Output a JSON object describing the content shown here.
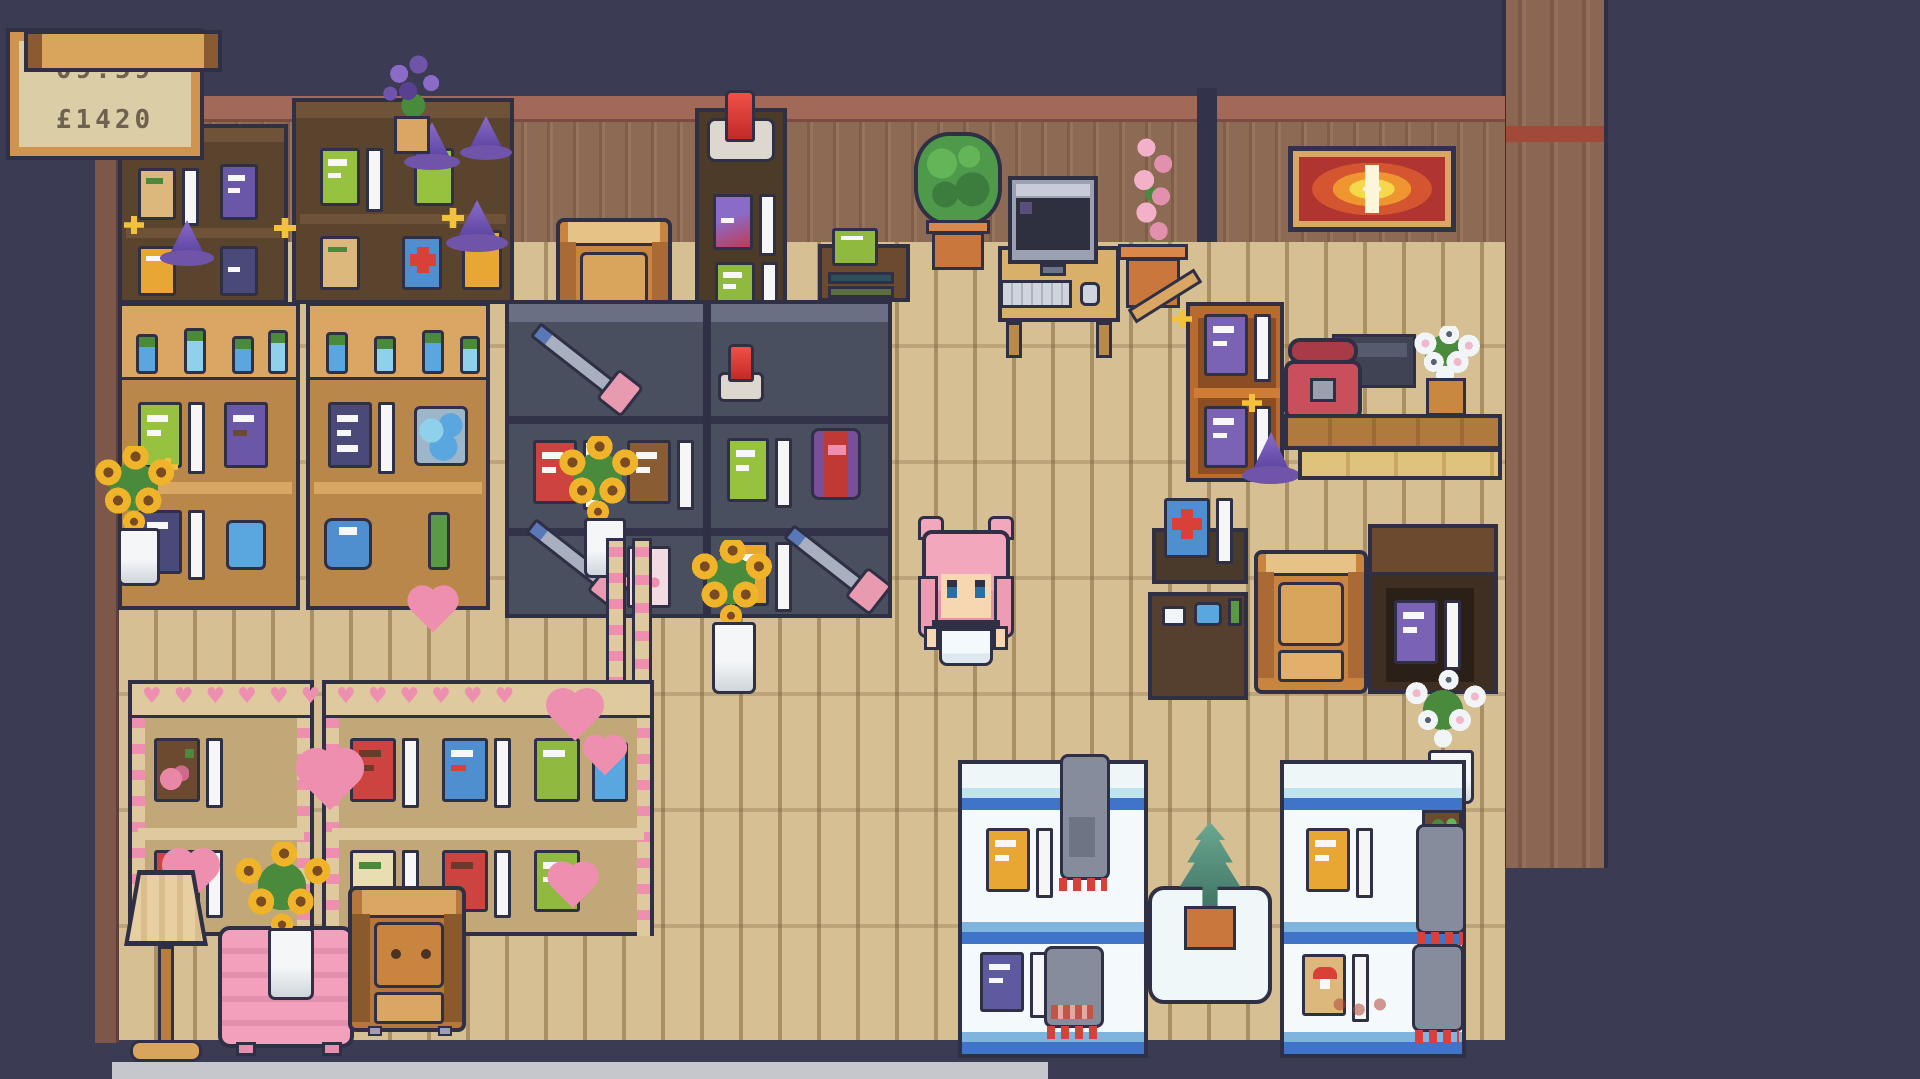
{
  "hud": {
    "time": "09:59",
    "money": "£1420"
  },
  "scene": {
    "setting": "pixel-art magic shop interior, top-down view",
    "player": "pink-haired character in white dress standing on wood floor",
    "objects": [
      "dark bookshelves with wizard hats",
      "tan potion shelves",
      "gray weapon shelves with axes",
      "display case with red crystal",
      "armchairs",
      "computer desk with monitor keyboard mouse",
      "round topiary plant",
      "pink hyacinth pot",
      "lavender pot",
      "fire painting",
      "orange shelf with purple tomes",
      "red telephone",
      "dark cash register",
      "white daisy pot",
      "wooden benches",
      "first-aid book stand",
      "dark table with purple tome",
      "white flower bouquet",
      "blue-striped display shelves with creatures",
      "white table with pine plant",
      "heart-trimmed shelves",
      "floor lamp",
      "pink table with sunflowers",
      "sunflower vases",
      "red crystal on shelf"
    ]
  },
  "palette": {
    "background": "#3b3b54",
    "outline": "#2f2f45",
    "floor": "#d6bf92",
    "wall": "#8d6a54",
    "wall_trim": "#a26858",
    "hud_wood": "#cf9550",
    "hud_paper": "#dbcda6",
    "accent_pink": "#f2a7bc",
    "accent_blue": "#4f8fd0",
    "accent_gold": "#e8a633",
    "accent_red": "#cc4340",
    "accent_purple": "#7a63b5"
  }
}
